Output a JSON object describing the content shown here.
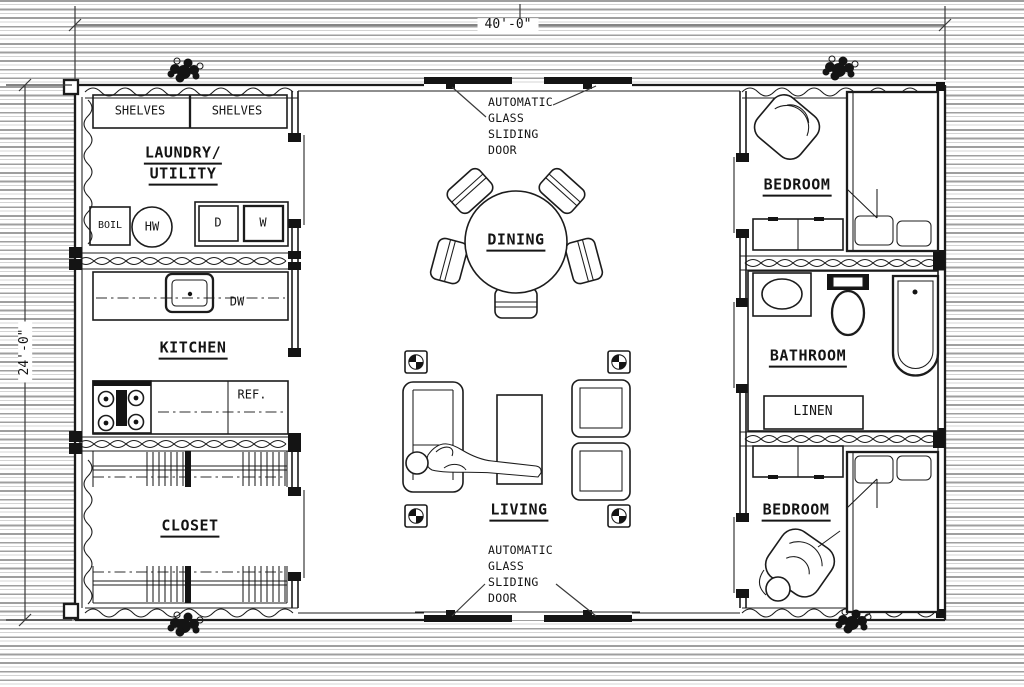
{
  "dimensions": {
    "width": "40'-0\"",
    "height": "24'-0\""
  },
  "rooms": {
    "laundry_line1": "LAUNDRY/",
    "laundry_line2": "UTILITY",
    "kitchen": "KITCHEN",
    "closet": "CLOSET",
    "dining": "DINING",
    "living": "LIVING",
    "bedroom_top": "BEDROOM",
    "bathroom": "BATHROOM",
    "linen": "LINEN",
    "bedroom_bottom": "BEDROOM"
  },
  "fixtures": {
    "shelves_left": "SHELVES",
    "shelves_right": "SHELVES",
    "boiler": "BOIL",
    "water_heater": "HW",
    "dryer": "D",
    "washer": "W",
    "dishwasher": "DW",
    "refrigerator": "REF."
  },
  "doors": {
    "top": {
      "line1": "AUTOMATIC",
      "line2": "GLASS",
      "line3": "SLIDING",
      "line4": "DOOR"
    },
    "bottom": {
      "line1": "AUTOMATIC",
      "line2": "GLASS",
      "line3": "SLIDING",
      "line4": "DOOR"
    }
  },
  "colors": {
    "line": "#1c1c1c",
    "paper": "#ffffff",
    "ruling": "#9f9f9f",
    "tile_grid": "#9a9a9a"
  }
}
